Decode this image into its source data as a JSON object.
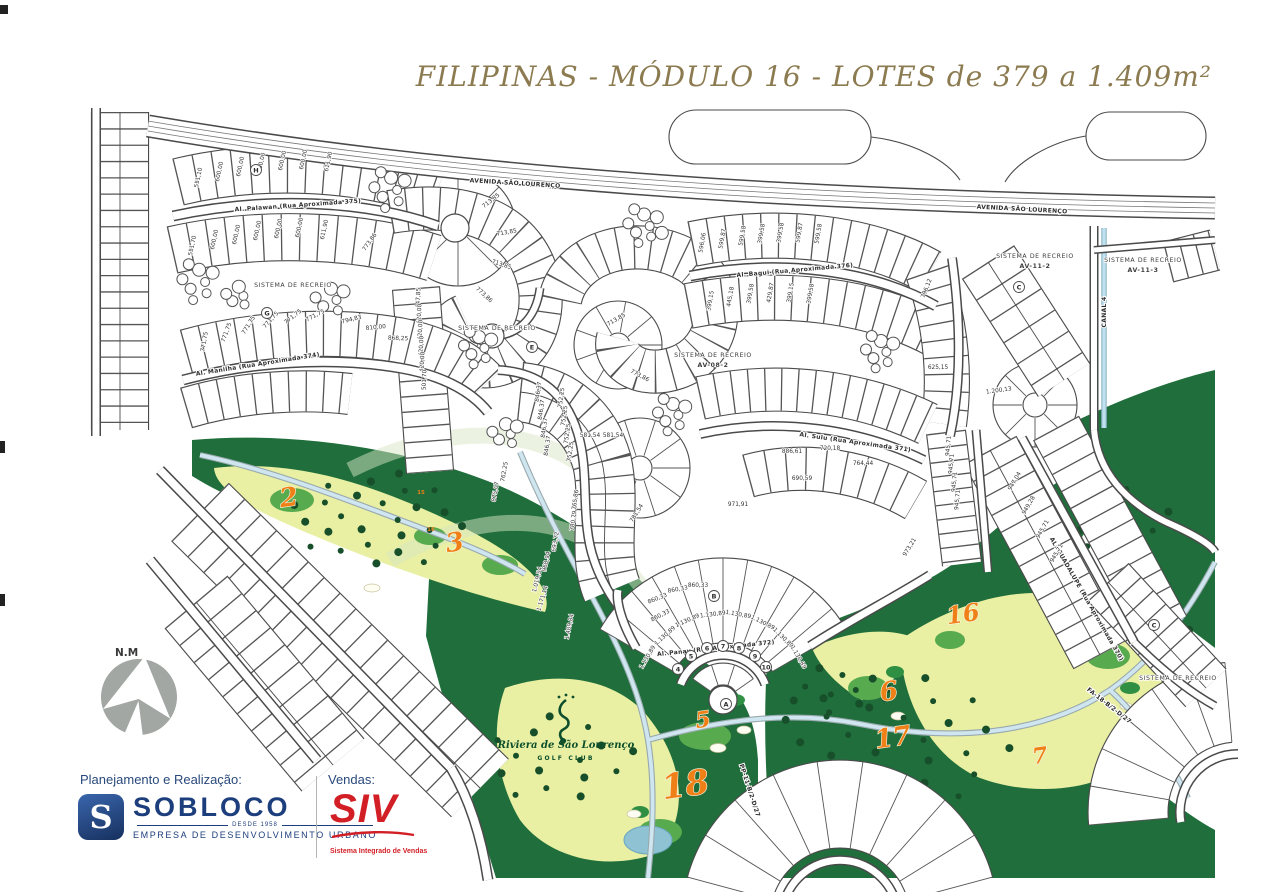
{
  "title": "FILIPINAS - MÓDULO 16 - LOTES de 379 a 1.409m²",
  "compass": {
    "label": "N.M"
  },
  "club": {
    "name": "Riviera de São Lourenço",
    "sub": "GOLF CLUB"
  },
  "footer": {
    "planning_label": "Planejamento e Realização:",
    "sobloco": {
      "initial": "S",
      "name": "SOBLOCO",
      "since": "DESDE 1958",
      "tagline": "EMPRESA DE DESENVOLVIMENTO URBANO"
    },
    "sales_label": "Vendas:",
    "siv": {
      "name": "SIV",
      "tagline": "Sistema Integrado de Vendas"
    }
  },
  "colors": {
    "title_gold": "#8c7b50",
    "line": "#4a4a4a",
    "navy": "#1d3e7c",
    "red": "#d21f26",
    "golf_dark": "#1f6e3b",
    "golf_mid": "#57aa4e",
    "golf_light": "#e9efa3",
    "hole_orange": "#ef8018",
    "path_blue": "#cfe5ef",
    "pond_blue": "#8fc3d4",
    "compass_gray": "#a2a7a4"
  },
  "map": {
    "street_labels": [
      {
        "t": "AVENIDA SÃO LOURENÇO",
        "x": 515,
        "y": 185,
        "r": 3.5,
        "s": 7,
        "ls": 1.5
      },
      {
        "t": "AVENIDA SÃO LOURENÇO",
        "x": 1022,
        "y": 211,
        "r": 3,
        "s": 7,
        "ls": 1.5
      },
      {
        "t": "Al. Palawan  (Rua Aproximada 375)",
        "x": 298,
        "y": 207,
        "r": -4,
        "s": 6
      },
      {
        "t": "Al. Manilha  (Rua Aproximada 374)",
        "x": 258,
        "y": 366,
        "r": -9,
        "s": 6
      },
      {
        "t": "Al. Bagui  (Rua Aproximada 376)",
        "x": 795,
        "y": 272,
        "r": -5,
        "s": 6
      },
      {
        "t": "Al. Sulu  (Rua Aproximada 371)",
        "x": 855,
        "y": 444,
        "r": 8,
        "s": 6
      },
      {
        "t": "Al. Panay  (Rua Aproximada 372)",
        "x": 716,
        "y": 650,
        "r": -6,
        "s": 6
      },
      {
        "t": "AL. GUADALUPE (Rua Aproximada 370)",
        "x": 1085,
        "y": 600,
        "r": 60,
        "s": 5.5
      },
      {
        "t": "CANAL 4",
        "x": 1106,
        "y": 312,
        "r": -90,
        "s": 6
      },
      {
        "t": "FA-18-B/2-D/27",
        "x": 1108,
        "y": 707,
        "r": 38,
        "s": 5
      },
      {
        "t": "PP-11-B/2-D/27",
        "x": 748,
        "y": 791,
        "r": 72,
        "s": 5
      }
    ],
    "area_labels": [
      {
        "t": "SISTEMA DE RECREIO",
        "x": 293,
        "y": 287
      },
      {
        "t": "SISTEMA DE RECREIO",
        "x": 497,
        "y": 330
      },
      {
        "t": "SISTEMA DE RECREIO",
        "x": 713,
        "y": 357
      },
      {
        "t": "AV-08-2",
        "x": 713,
        "y": 367,
        "b": 1
      },
      {
        "t": "SISTEMA DE RECREIO",
        "x": 1035,
        "y": 258
      },
      {
        "t": "AV-11-2",
        "x": 1035,
        "y": 268,
        "b": 1
      },
      {
        "t": "SISTEMA DE RECREIO",
        "x": 1143,
        "y": 262
      },
      {
        "t": "AV-11-3",
        "x": 1143,
        "y": 272,
        "b": 1
      },
      {
        "t": "SISTEMA DE RECREIO",
        "x": 1178,
        "y": 680
      }
    ],
    "lot_labels": [
      [
        "551,10",
        200,
        178,
        -78
      ],
      [
        "600,00",
        221,
        172,
        -78
      ],
      [
        "600,00",
        242,
        167,
        -78
      ],
      [
        "600,00",
        263,
        163,
        -78
      ],
      [
        "600,00",
        284,
        161,
        -78
      ],
      [
        "600,00",
        305,
        160,
        -78
      ],
      [
        "611,90",
        330,
        162,
        -78
      ],
      [
        "551,70",
        194,
        246,
        -78
      ],
      [
        "600,00",
        216,
        240,
        -78
      ],
      [
        "600,00",
        238,
        235,
        -78
      ],
      [
        "600,00",
        259,
        231,
        -78
      ],
      [
        "600,00",
        280,
        229,
        -78
      ],
      [
        "600,00",
        301,
        228,
        -78
      ],
      [
        "611,90",
        326,
        230,
        -78
      ],
      [
        "773,86",
        371,
        243,
        -55
      ],
      [
        "713,85",
        492,
        202,
        -38
      ],
      [
        "713,85",
        507,
        234,
        -10
      ],
      [
        "713,85",
        501,
        266,
        18
      ],
      [
        "773,86",
        483,
        296,
        42
      ],
      [
        "771,75",
        206,
        342,
        -80
      ],
      [
        "771,75",
        228,
        333,
        -70
      ],
      [
        "771,75",
        250,
        326,
        -58
      ],
      [
        "771,75",
        272,
        321,
        -48
      ],
      [
        "771,75",
        294,
        318,
        -38
      ],
      [
        "771,75",
        316,
        317,
        -28
      ],
      [
        "794,83",
        352,
        321,
        -14
      ],
      [
        "810,00",
        376,
        329,
        -6
      ],
      [
        "868,25",
        398,
        340,
        2
      ],
      [
        "447,85",
        420,
        298,
        -88
      ],
      [
        "420,00",
        421,
        314,
        -88
      ],
      [
        "420,00",
        422,
        330,
        -88
      ],
      [
        "420,00",
        423,
        346,
        -88
      ],
      [
        "420,00",
        424,
        362,
        -88
      ],
      [
        "501,70",
        426,
        380,
        -88
      ],
      [
        "846,37",
        540,
        392,
        -82
      ],
      [
        "846,37",
        543,
        410,
        -82
      ],
      [
        "846,37",
        546,
        428,
        -82
      ],
      [
        "846,37",
        549,
        446,
        -82
      ],
      [
        "752,25",
        563,
        398,
        -82
      ],
      [
        "752,25",
        566,
        416,
        -82
      ],
      [
        "752,25",
        569,
        434,
        -82
      ],
      [
        "752,25",
        572,
        452,
        -82
      ],
      [
        "762,25",
        506,
        472,
        -80
      ],
      [
        "875,07",
        497,
        492,
        -80
      ],
      [
        "765,86",
        577,
        500,
        -82
      ],
      [
        "780,79",
        575,
        521,
        -82
      ],
      [
        "693,72",
        557,
        542,
        -80
      ],
      [
        "968,94",
        548,
        562,
        -78
      ],
      [
        "1.019,54",
        539,
        580,
        -76
      ],
      [
        "1.171,14",
        544,
        599,
        -73
      ],
      [
        "581,54",
        590,
        437,
        0
      ],
      [
        "581,54",
        613,
        437,
        0
      ],
      [
        "781,54",
        638,
        514,
        -58
      ],
      [
        "713,85",
        617,
        321,
        -30
      ],
      [
        "773,86",
        639,
        377,
        28
      ],
      [
        "596,06",
        704,
        243,
        -80
      ],
      [
        "599,87",
        724,
        239,
        -80
      ],
      [
        "599,58",
        744,
        236,
        -80
      ],
      [
        "399,58",
        763,
        234,
        -80
      ],
      [
        "399,58",
        782,
        233,
        -80
      ],
      [
        "599,87",
        801,
        233,
        -80
      ],
      [
        "599,58",
        820,
        234,
        -80
      ],
      [
        "399,15",
        712,
        301,
        -80
      ],
      [
        "445,18",
        732,
        297,
        -80
      ],
      [
        "399,58",
        752,
        294,
        -80
      ],
      [
        "429,87",
        772,
        293,
        -80
      ],
      [
        "399,15",
        792,
        293,
        -80
      ],
      [
        "399,58",
        812,
        294,
        -80
      ],
      [
        "796,12",
        928,
        289,
        -68
      ],
      [
        "625,15",
        938,
        369,
        0
      ],
      [
        "1.200,13",
        999,
        392,
        -8
      ],
      [
        "886,61",
        792,
        453,
        0
      ],
      [
        "720,18",
        830,
        450,
        0
      ],
      [
        "764,44",
        863,
        465,
        0
      ],
      [
        "690,59",
        802,
        480,
        0
      ],
      [
        "971,91",
        738,
        506,
        0
      ],
      [
        "1.130,89",
        649,
        658,
        -60
      ],
      [
        "1.130,89",
        666,
        637,
        -42
      ],
      [
        "1.130,89",
        688,
        622,
        -24
      ],
      [
        "1.130,89",
        713,
        616,
        -7
      ],
      [
        "1.130,89",
        738,
        616,
        10
      ],
      [
        "1.130,89",
        762,
        624,
        27
      ],
      [
        "1.130,89",
        782,
        639,
        44
      ],
      [
        "1.130,89",
        797,
        658,
        60
      ],
      [
        "1.409,84",
        571,
        627,
        -78
      ],
      [
        "860,33",
        658,
        600,
        -22
      ],
      [
        "860,33",
        678,
        591,
        -10
      ],
      [
        "860,33",
        698,
        587,
        0
      ],
      [
        "860,33",
        661,
        617,
        -28
      ],
      [
        "945,71",
        950,
        446,
        -85
      ],
      [
        "945,71",
        953,
        464,
        -85
      ],
      [
        "945,71",
        956,
        482,
        -85
      ],
      [
        "945,71",
        959,
        500,
        -85
      ],
      [
        "947,04",
        1016,
        482,
        -60
      ],
      [
        "949,28",
        1030,
        506,
        -60
      ],
      [
        "945,71",
        1044,
        530,
        -60
      ],
      [
        "945,71",
        1058,
        554,
        -60
      ],
      [
        "973,21",
        911,
        548,
        -58
      ]
    ],
    "markers": [
      [
        "H",
        256,
        170
      ],
      [
        "G",
        267,
        313
      ],
      [
        "E",
        532,
        347
      ],
      [
        "C",
        1019,
        287
      ],
      [
        "B",
        714,
        596
      ],
      [
        "A",
        726,
        704
      ],
      [
        "C",
        1154,
        625
      ],
      [
        "4",
        678,
        669
      ],
      [
        "5",
        691,
        656
      ],
      [
        "6",
        707,
        648
      ],
      [
        "7",
        723,
        646
      ],
      [
        "8",
        739,
        648
      ],
      [
        "9",
        755,
        656
      ],
      [
        "10",
        766,
        667
      ]
    ],
    "holes": [
      [
        "2",
        290,
        506,
        26
      ],
      [
        "3",
        456,
        551,
        26
      ],
      [
        "5",
        704,
        727,
        22
      ],
      [
        "6",
        890,
        700,
        26
      ],
      [
        "7",
        1041,
        763,
        22
      ],
      [
        "16",
        964,
        622,
        24
      ],
      [
        "17",
        894,
        746,
        26
      ],
      [
        "18",
        687,
        796,
        34
      ]
    ],
    "tees": [
      [
        "15",
        421,
        494
      ],
      [
        "16",
        431,
        531
      ]
    ]
  }
}
